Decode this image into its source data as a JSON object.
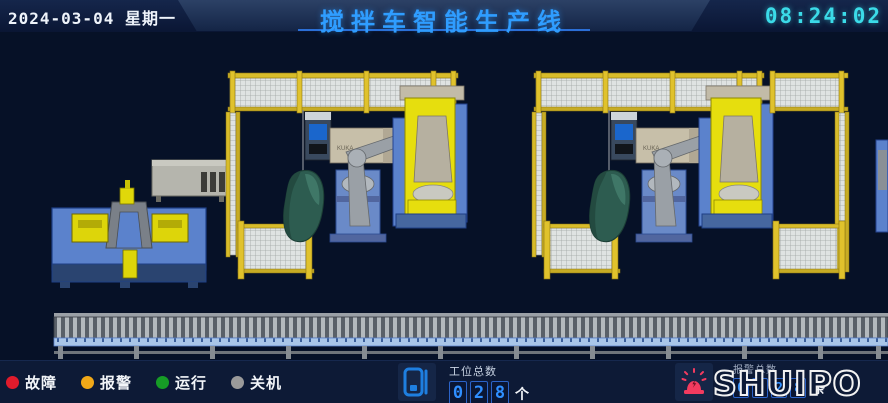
{
  "header": {
    "date": "2024-03-04",
    "weekday": "星期一",
    "title": "搅拌车智能生产线",
    "time": "08:24:02"
  },
  "colors": {
    "title_blue": "#2f9dff",
    "clock_cyan": "#3bdbe8",
    "scene_bg": "#061127",
    "bottom_bar_bg": "#0d1a36",
    "digit_blue": "#2f8fff",
    "fault_red": "#e01b2c",
    "alarm_orange": "#f0a818",
    "running_green": "#169c26",
    "off_gray": "#9a9a9a",
    "fence_yellow": "#d8bc2a",
    "machine_blue": "#5b82cc",
    "robot_gray": "#9aa0a6",
    "positioner_yellow": "#e6de0e",
    "drum_green": "#2d5c50",
    "conveyor_rail_blue": "#a9c6e8",
    "beacon_pink": "#f23b5f",
    "station_icon_blue": "#1e7fe0",
    "logo_outline": "#f2f2f2"
  },
  "legend": {
    "items": [
      {
        "label": "故障",
        "color": "#e01b2c"
      },
      {
        "label": "报警",
        "color": "#f0a818"
      },
      {
        "label": "运行",
        "color": "#169c26"
      },
      {
        "label": "关机",
        "color": "#9a9a9a"
      }
    ]
  },
  "station_counter": {
    "label": "工位总数",
    "digits": [
      "0",
      "2",
      "8"
    ],
    "unit": "个"
  },
  "alarm_counter": {
    "label": "报警总数",
    "digits": [
      "0",
      "0",
      "2",
      "8"
    ],
    "unit": "条"
  },
  "logo": {
    "text": "SHUIPO"
  },
  "scene": {
    "robot_cabinet_label": "KUKA",
    "cells": [
      "robot-welding-cell-1",
      "robot-welding-cell-2"
    ]
  }
}
